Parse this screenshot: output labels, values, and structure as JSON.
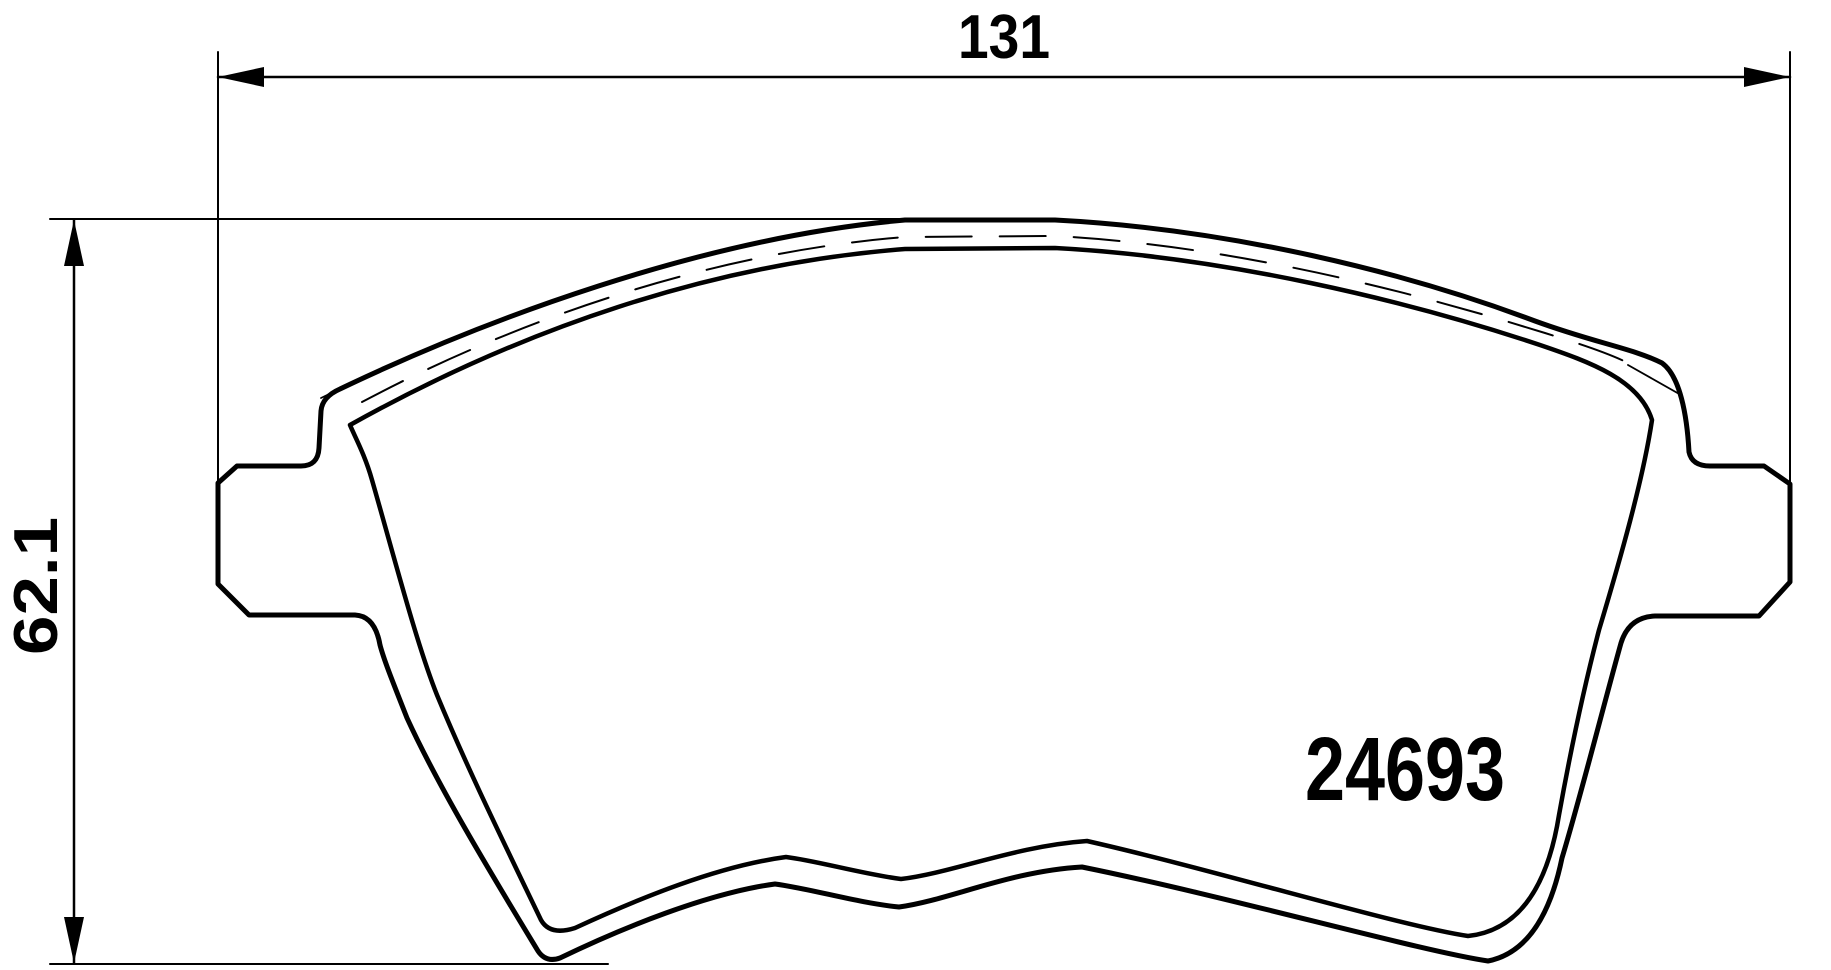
{
  "drawing": {
    "type": "brake-pad-technical-drawing",
    "background": "#ffffff",
    "line_color": "#000000",
    "part_number": "24693",
    "dimensions": {
      "width": {
        "value": "131"
      },
      "height": {
        "value": "62.1"
      }
    }
  }
}
